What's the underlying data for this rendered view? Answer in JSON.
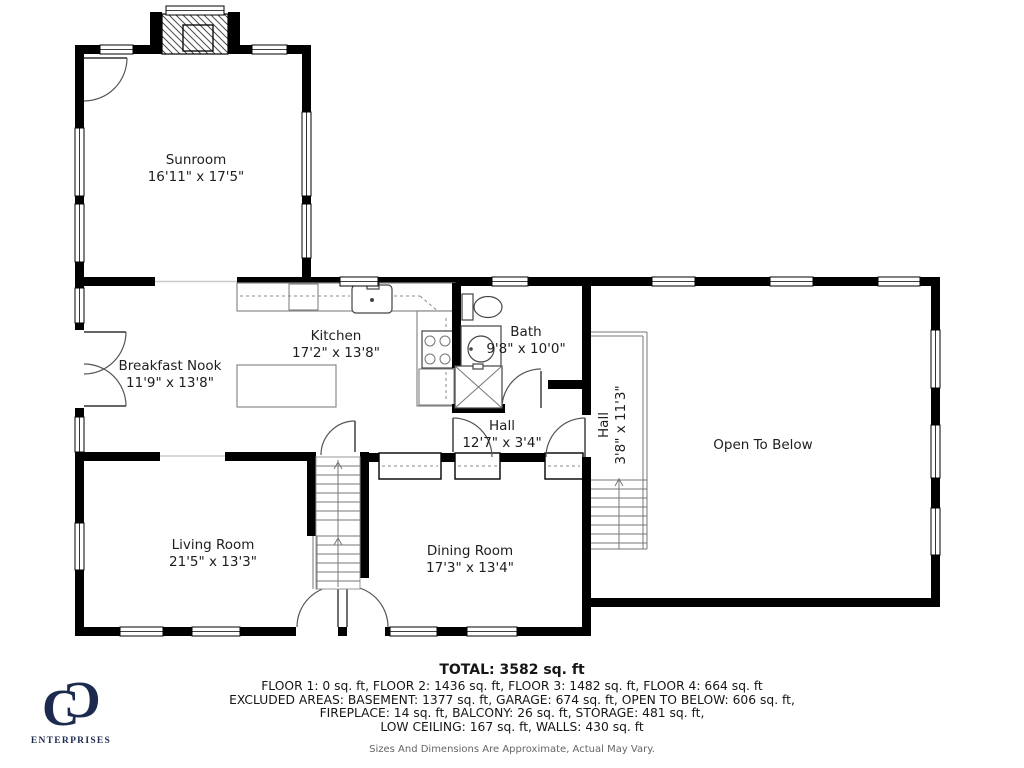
{
  "colors": {
    "wall": "#000000",
    "navy": "#1c2b4d",
    "line": "#555555"
  },
  "rooms": {
    "sunroom": {
      "name": "Sunroom",
      "dims": "16'11\" x 17'5\""
    },
    "breakfast_nook": {
      "name": "Breakfast Nook",
      "dims": "11'9\" x 13'8\""
    },
    "kitchen": {
      "name": "Kitchen",
      "dims": "17'2\" x 13'8\""
    },
    "bath": {
      "name": "Bath",
      "dims": "9'8\" x 10'0\""
    },
    "hall": {
      "name": "Hall",
      "dims": "12'7\" x 3'4\""
    },
    "hall_upper": {
      "name": "Hall",
      "dims": "3'8\" x 11'3\""
    },
    "open_to_below": {
      "name": "Open To Below"
    },
    "living_room": {
      "name": "Living Room",
      "dims": "21'5\" x 13'3\""
    },
    "dining_room": {
      "name": "Dining Room",
      "dims": "17'3\" x 13'4\""
    }
  },
  "footer": {
    "total": "TOTAL: 3582 sq. ft",
    "line1": "FLOOR 1: 0 sq. ft, FLOOR 2: 1436 sq. ft, FLOOR 3: 1482 sq. ft, FLOOR 4: 664 sq. ft",
    "line2": "EXCLUDED AREAS: BASEMENT: 1377 sq. ft, GARAGE: 674 sq. ft, OPEN TO BELOW: 606 sq. ft,",
    "line3": "FIREPLACE: 14 sq. ft, BALCONY: 26 sq. ft, STORAGE: 481 sq. ft,",
    "line4": "LOW CEILING: 167 sq. ft, WALLS: 430 sq. ft",
    "disclaimer": "Sizes And Dimensions Are Approximate, Actual May Vary."
  },
  "logo": {
    "monogram_left": "C",
    "monogram_right": "C",
    "text": "ENTERPRISES"
  }
}
